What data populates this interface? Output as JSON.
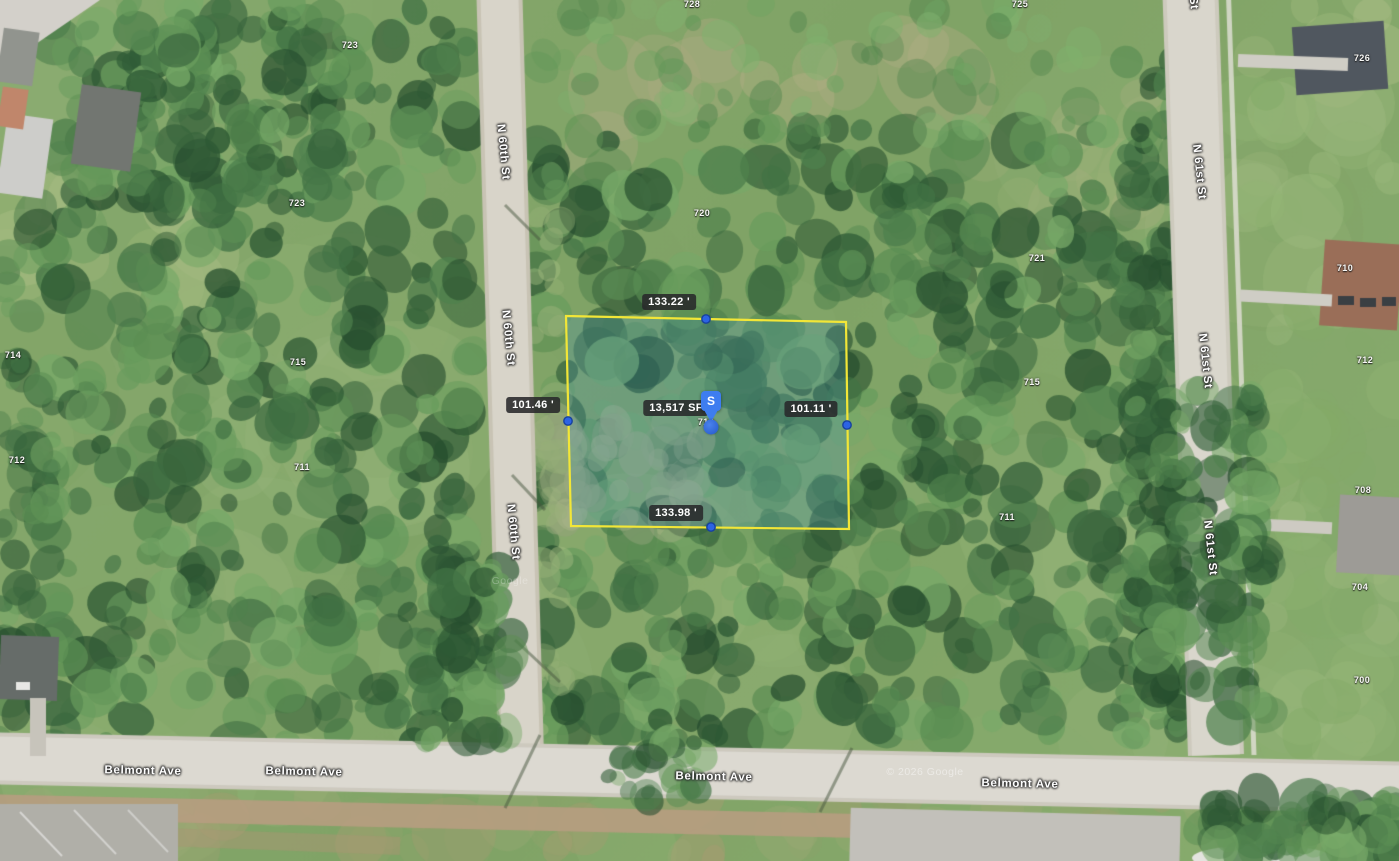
{
  "map": {
    "imagery_type": "satellite",
    "watermarks": [
      {
        "text": "© 2026 Google",
        "x": 925,
        "y": 772,
        "style": "primary"
      },
      {
        "text": "Google",
        "x": 510,
        "y": 581,
        "style": "faint"
      }
    ]
  },
  "parcel": {
    "area": {
      "text": "13,517 SF",
      "x": 676,
      "y": 408
    },
    "measurements": {
      "top": {
        "text": "133.22 '",
        "x": 669,
        "y": 302
      },
      "left": {
        "text": "101.46 '",
        "x": 533,
        "y": 405
      },
      "right": {
        "text": "101.11 '",
        "x": 811,
        "y": 409
      },
      "bottom": {
        "text": "133.98 '",
        "x": 676,
        "y": 513
      }
    },
    "marker": {
      "letter": "S",
      "pos": {
        "x": 711,
        "y": 391
      },
      "dot": {
        "x": 711,
        "y": 427
      }
    },
    "geometry": {
      "corners": [
        [
          566,
          316
        ],
        [
          846,
          322
        ],
        [
          849,
          529
        ],
        [
          571,
          526
        ]
      ],
      "midpoints": [
        [
          706,
          319
        ],
        [
          847,
          425
        ],
        [
          711,
          527
        ],
        [
          568,
          421
        ]
      ]
    },
    "colors": {
      "outline": "#f2e637",
      "fill": "rgba(70,145,175,0.28)",
      "vertex_fill": "#2c63e4",
      "vertex_stroke": "#17419e",
      "label_bg": "rgba(40,40,42,0.88)",
      "label_text": "#ffffff",
      "marker_blue": "#3e7df0"
    }
  },
  "streets": [
    {
      "name": "N 60th St",
      "orientation": "vertical",
      "rotation": 84.5,
      "labels": [
        {
          "x": 503,
          "y": 152
        },
        {
          "x": 508,
          "y": 338
        },
        {
          "x": 513,
          "y": 532
        }
      ]
    },
    {
      "name": "N 61st St",
      "orientation": "vertical",
      "rotation": 84,
      "labels": [
        {
          "x": 1191,
          "y": -18
        },
        {
          "x": 1199,
          "y": 172
        },
        {
          "x": 1205,
          "y": 361
        },
        {
          "x": 1210,
          "y": 548
        }
      ]
    },
    {
      "name": "Belmont Ave",
      "orientation": "horizontal",
      "rotation": 1.2,
      "labels": [
        {
          "x": 143,
          "y": 771
        },
        {
          "x": 304,
          "y": 772
        },
        {
          "x": 714,
          "y": 777
        },
        {
          "x": 1020,
          "y": 784
        }
      ]
    }
  ],
  "house_numbers": [
    {
      "t": "728",
      "x": 692,
      "y": 4
    },
    {
      "t": "725",
      "x": 1020,
      "y": 4
    },
    {
      "t": "723",
      "x": 350,
      "y": 45
    },
    {
      "t": "726",
      "x": 1362,
      "y": 58
    },
    {
      "t": "723",
      "x": 297,
      "y": 203
    },
    {
      "t": "720",
      "x": 702,
      "y": 213
    },
    {
      "t": "721",
      "x": 1037,
      "y": 258
    },
    {
      "t": "710",
      "x": 1345,
      "y": 268
    },
    {
      "t": "714",
      "x": 13,
      "y": 355
    },
    {
      "t": "715",
      "x": 298,
      "y": 362
    },
    {
      "t": "712",
      "x": 1365,
      "y": 360
    },
    {
      "t": "715",
      "x": 1032,
      "y": 382
    },
    {
      "t": "710",
      "x": 706,
      "y": 422
    },
    {
      "t": "712",
      "x": 17,
      "y": 460
    },
    {
      "t": "711",
      "x": 302,
      "y": 467
    },
    {
      "t": "708",
      "x": 1363,
      "y": 490
    },
    {
      "t": "711",
      "x": 1007,
      "y": 517
    },
    {
      "t": "704",
      "x": 1360,
      "y": 587
    },
    {
      "t": "700",
      "x": 1362,
      "y": 680
    }
  ]
}
